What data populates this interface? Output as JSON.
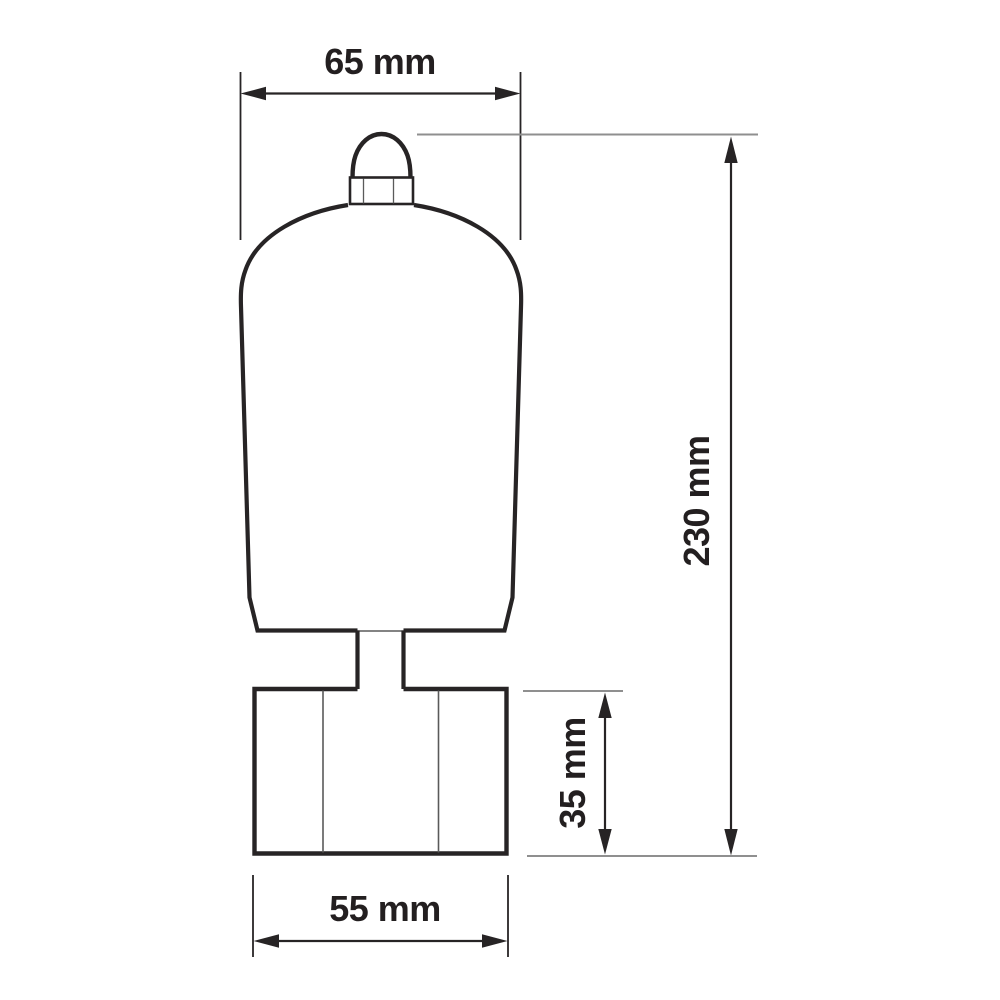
{
  "title": "Product dimension drawing",
  "colors": {
    "background": "#ffffff",
    "line": "#272425",
    "line_thin": "#5a5a5a",
    "aux_line": "#8f8f8f",
    "text": "#231f20"
  },
  "dimensions": {
    "width_top": {
      "label": "65 mm"
    },
    "height_total": {
      "label": "230 mm"
    },
    "height_base": {
      "label": "35 mm"
    },
    "width_base": {
      "label": "55 mm"
    }
  }
}
